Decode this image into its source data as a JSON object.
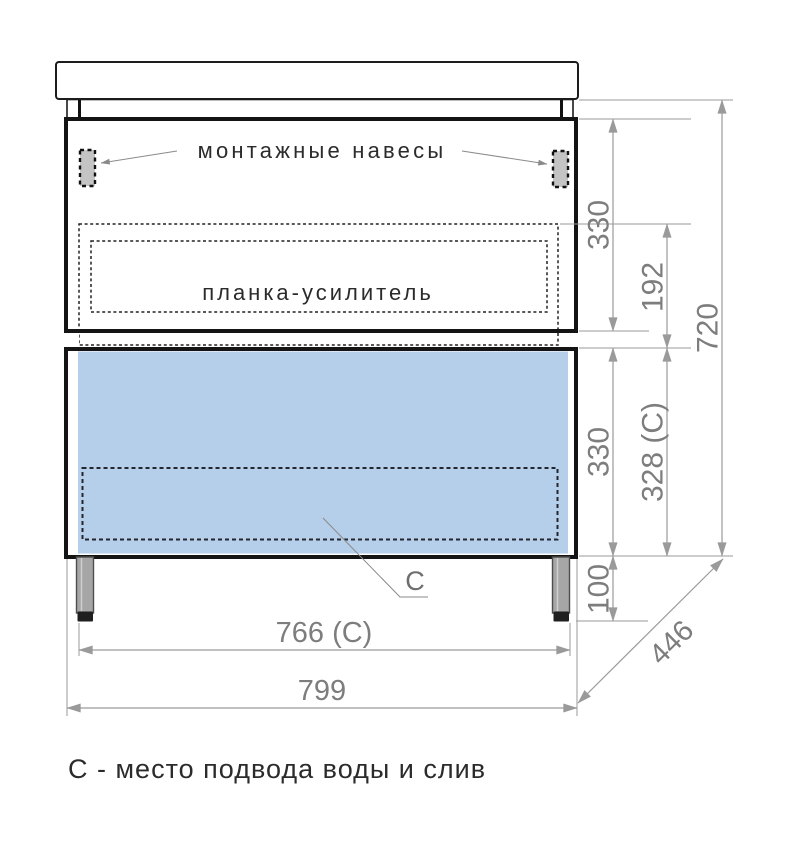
{
  "annotations": {
    "mounting_hangers_label": "монтажные навесы",
    "reinforcement_strip_label": "планка-усилитель",
    "drain_marker": "С",
    "footnote": "С - место подвода воды и слив"
  },
  "dimensions": {
    "upper_section_height_mm": "330",
    "strip_to_drawer_mm": "192",
    "body_height_mm": "720",
    "drawer_section_height_mm": "330",
    "drawer_section_height_c_mm": "328 (С)",
    "legs_height_mm": "100",
    "between_legs_width_mm": "766 (С)",
    "overall_width_mm": "799",
    "depth_mm": "446"
  },
  "colors": {
    "drawer_front": "#b5cee9",
    "reinforcement_strip": "#c7c7c7",
    "bracket_fill": "#c4c4c4",
    "leg_fill": "#a6a6a6",
    "leg_foot": "#1f1f1f",
    "outline": "#141414",
    "dimension_gray": "#9a9a9a"
  }
}
